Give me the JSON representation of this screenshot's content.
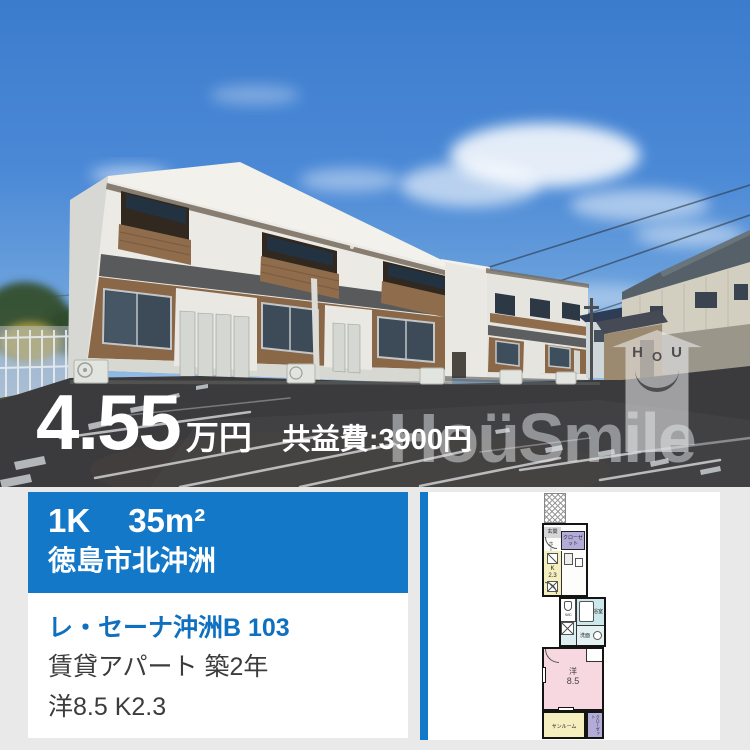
{
  "photo": {
    "price_value": "4.55",
    "price_unit": "万円",
    "maintenance_fee": "共益費:3900円",
    "watermark_text": "HoüSmile",
    "watermark_house": {
      "h": "H",
      "o": "O",
      "u": "U"
    }
  },
  "summary": {
    "layout": "1K",
    "size": "35m²",
    "location": "徳島市北沖洲"
  },
  "details": {
    "name": "レ・セーナ沖洲B 103",
    "building_info": "賃貸アパート  築2年",
    "room_info": "洋8.5 K2.3"
  },
  "floorplan": {
    "entrance": "玄関",
    "hall": "ホール",
    "closet_upper": "クローゼット",
    "kitchen_k": "K",
    "kitchen_size": "2.3",
    "wc": "WC",
    "bath": "浴室",
    "washroom": "洗面",
    "room_label": "洋",
    "room_size": "8.5",
    "sunroom": "サンルーム",
    "closet_lower": "クローゼット"
  },
  "colors": {
    "accent_blue": "#1478c8",
    "link_blue": "#1070c0"
  }
}
